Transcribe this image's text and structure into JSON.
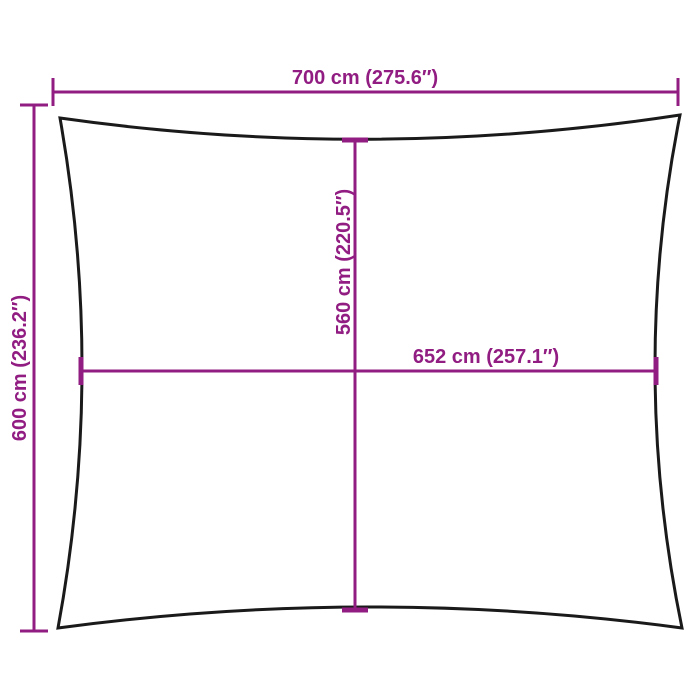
{
  "diagram": {
    "labels": {
      "width": "700 cm (275.6″)",
      "height": "600 cm (236.2″)",
      "inner_height": "560 cm (220.5″)",
      "inner_width": "652 cm (257.1″)"
    },
    "colors": {
      "dimension_accent": "#911d82",
      "outline": "#1a1a1a",
      "background": "#ffffff"
    }
  }
}
